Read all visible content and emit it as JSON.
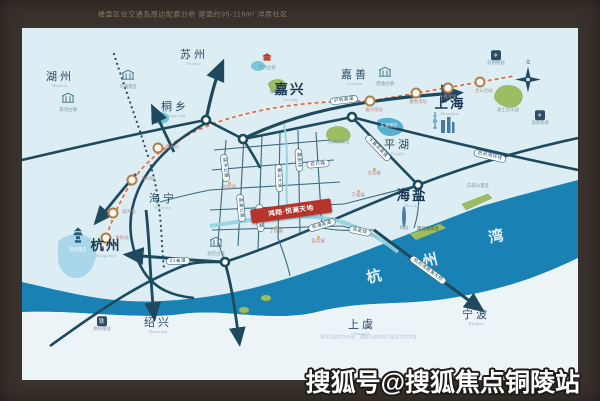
{
  "frame": {
    "caption": "楼盘区位交通及周边配套分析 建面约95-116m² 洋房社区",
    "watermark": "搜狐号@搜狐焦点铜陵站"
  },
  "colors": {
    "frame_brown": "#3a322c",
    "land_blue": "#dcedf4",
    "bay_blue": "#1a81b4",
    "road_navy": "#1d4a5e",
    "project_red": "#b5342b"
  },
  "map": {
    "project": {
      "label": "鸿翔·悦澜天地"
    },
    "disclaimer": "本区位图仅为示意，最终以政府部门批准文件为准",
    "compass": "北",
    "bay_chars": [
      "杭",
      "州",
      "湾"
    ],
    "glyphs": {
      "airport": "✈",
      "rail": "铁"
    },
    "cities": [
      {
        "name": "湖州",
        "en": "Huzhou"
      },
      {
        "name": "苏州",
        "en": "Suzhou"
      },
      {
        "name": "桐乡",
        "en": "Tongxiang"
      },
      {
        "name": "嘉兴",
        "en": "Jiaxing"
      },
      {
        "name": "嘉善",
        "en": "Jiashan"
      },
      {
        "name": "上海",
        "en": "Shanghai"
      },
      {
        "name": "平湖",
        "en": "Pinghu"
      },
      {
        "name": "海盐",
        "en": "Haiyan"
      },
      {
        "name": "海宁",
        "en": "Haining"
      },
      {
        "name": "杭州",
        "en": "Hangzhou"
      },
      {
        "name": "绍兴",
        "en": "Shaoxing"
      },
      {
        "name": "上虞",
        "en": "Shangyu"
      },
      {
        "name": "宁波",
        "en": "Ningbo"
      }
    ],
    "roads": [
      "沪杭高速",
      "杭州湾环线",
      "乍嘉苏高速",
      "01省道",
      "硖许公路",
      "盐湖公路",
      "秦山大道",
      "海宁大道",
      "嘉南线",
      "翁金线",
      "杭州湾跨海大桥",
      "百尺路",
      "杭浦高速"
    ],
    "stations": [
      "余杭站",
      "临平站",
      "许村站",
      "桐乡站",
      "嘉兴南站",
      "嘉善南站",
      "枫泾站",
      "金山北站"
    ],
    "towns": [
      "斜桥镇",
      "丁桥镇",
      "袁花镇",
      "沈荡镇",
      "于城镇"
    ],
    "pois": [
      "南浔古镇",
      "乌镇景区",
      "月河古街",
      "湘家荡",
      "南湖风景区",
      "东湖景区",
      "西塘古镇",
      "迪士尼乐园",
      "虹桥枢纽",
      "浦东机场",
      "杭州南站",
      "西湖景区",
      "绮园",
      "南北湖景区",
      "白塔山景区",
      "盐官古城"
    ]
  }
}
